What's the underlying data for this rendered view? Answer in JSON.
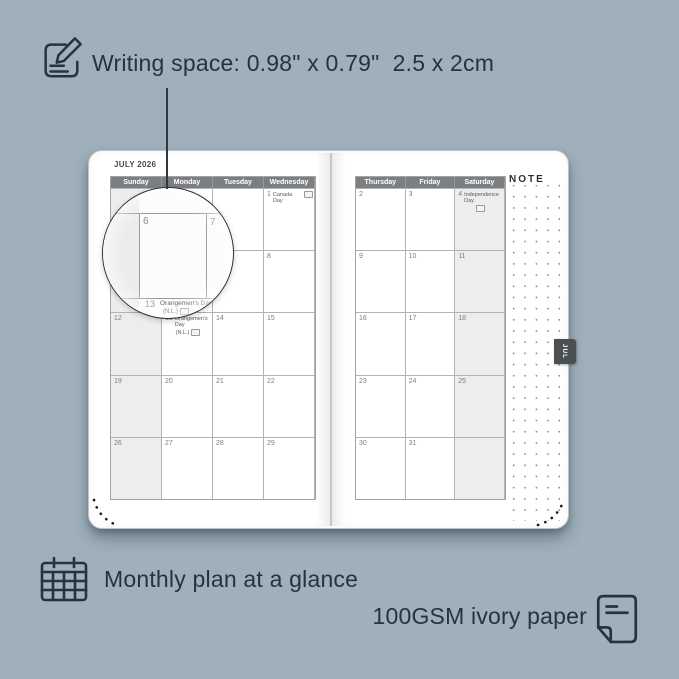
{
  "colors": {
    "background": "#9FB0BB",
    "ink": "#26333D",
    "page": "#FFFFFF",
    "header_bg": "#7C7F82",
    "header_text": "#FFFFFF",
    "shaded_column": "#EDEDED",
    "grid_line": "#B3B3B3",
    "tab_bg": "#4A4F53",
    "note_dot": "#8F8F8F"
  },
  "icons": {
    "note_pencil": "note-pencil-icon",
    "calendar_grid": "calendar-grid-icon",
    "paper_sheet": "paper-sheet-icon",
    "holiday_flag": "holiday-flag-icon"
  },
  "annotations": {
    "writing_space": "Writing space: 0.98\" x 0.79\"  2.5 x 2cm",
    "monthly_plan": "Monthly plan at a glance",
    "paper": "100GSM ivory paper"
  },
  "planner": {
    "month_title": "JULY 2026",
    "tab_label": "JUL",
    "note_label": "NOTE",
    "left_days": [
      "Sunday",
      "Monday",
      "Tuesday",
      "Wednesday"
    ],
    "right_days": [
      "Thursday",
      "Friday",
      "Saturday"
    ],
    "left_cells": [
      [
        {},
        {},
        {},
        {
          "d": "1",
          "h1": "Canada Day",
          "flag": "line1"
        }
      ],
      [
        {
          "d": "5"
        },
        {
          "d": "6"
        },
        {
          "d": "7"
        },
        {
          "d": "8"
        }
      ],
      [
        {
          "d": "12"
        },
        {
          "d": "13",
          "h1": "Orangemen's Day",
          "h2": "(N.L.)",
          "flag": "line2"
        },
        {
          "d": "14"
        },
        {
          "d": "15"
        }
      ],
      [
        {
          "d": "19"
        },
        {
          "d": "20"
        },
        {
          "d": "21"
        },
        {
          "d": "22"
        }
      ],
      [
        {
          "d": "26"
        },
        {
          "d": "27"
        },
        {
          "d": "28"
        },
        {
          "d": "29"
        }
      ]
    ],
    "right_cells": [
      [
        {
          "d": "2"
        },
        {
          "d": "3"
        },
        {
          "d": "4",
          "h1": "Independence Day",
          "flag": "line2"
        }
      ],
      [
        {
          "d": "9"
        },
        {
          "d": "10"
        },
        {
          "d": "11"
        }
      ],
      [
        {
          "d": "16"
        },
        {
          "d": "17"
        },
        {
          "d": "18"
        }
      ],
      [
        {
          "d": "23"
        },
        {
          "d": "24"
        },
        {
          "d": "25"
        }
      ],
      [
        {
          "d": "30"
        },
        {
          "d": "31"
        },
        {}
      ]
    ],
    "magnifier": {
      "day6": "6",
      "day7": "7",
      "day13": "13",
      "holiday": "Orangemen's Day",
      "holiday_region": "(N.L.)"
    }
  }
}
